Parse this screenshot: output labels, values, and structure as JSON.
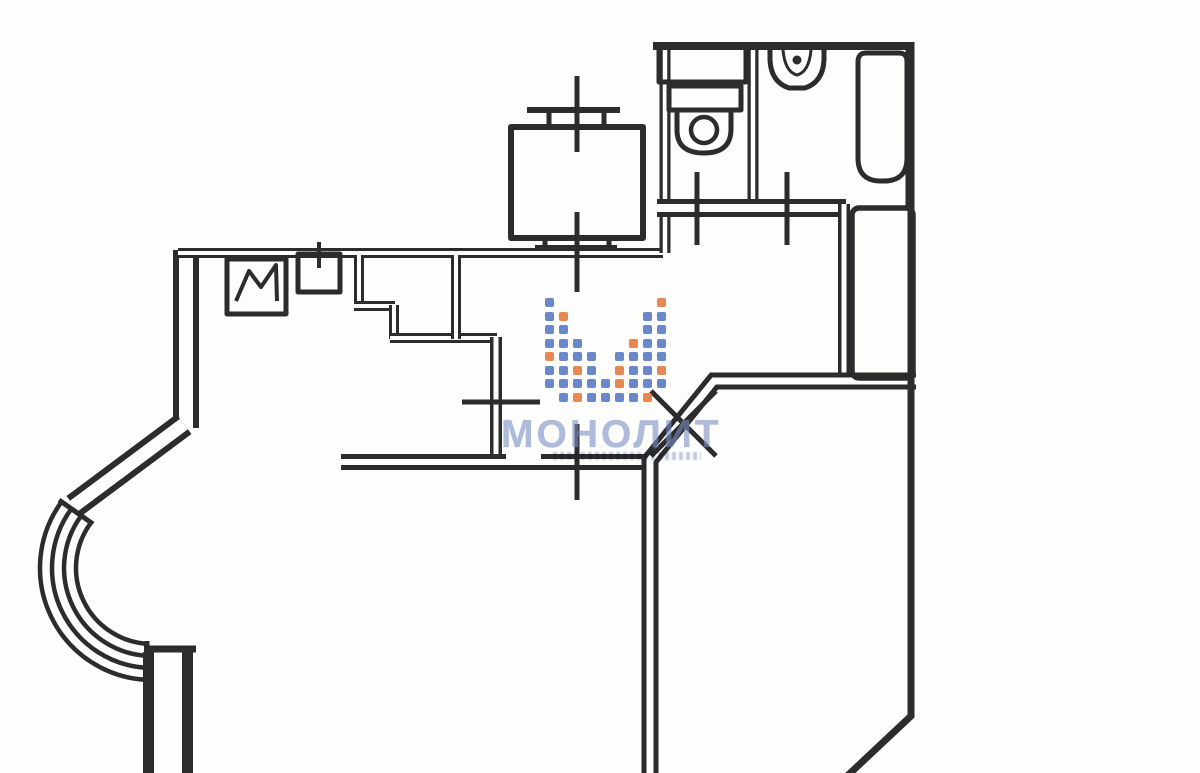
{
  "watermark": {
    "brand_text": "МОНОЛИТ",
    "text_color": "rgba(122,143,196,0.60)",
    "dot_blue": "#5577c2",
    "dot_orange": "#e4763a",
    "dot_grid": {
      "x": 545,
      "y": 298,
      "step_x": 14,
      "step_y": 13.5,
      "dot_size": 9
    },
    "dot_pattern": [
      "b.......o",
      "bo.....bb",
      "bb.....bb",
      "bbb...obb",
      "obbb.bbbb",
      "bbob.obbo",
      "bbbbbobbb",
      ".bobbbbo."
    ],
    "text_pos": {
      "x": 501,
      "y": 413
    },
    "tagline_pos": {
      "x": 553,
      "y": 452
    }
  },
  "floorplan": {
    "ink": "#2c2c2c",
    "paper": "#fdfdfc",
    "walls": [
      {
        "name": "left-outer-wall-upper",
        "d": "M 186 250 L 186 428",
        "band": 26,
        "gap": 14
      },
      {
        "name": "bay-pier-wall",
        "d": "M 184 424 L 74 506",
        "band": 25,
        "gap": 13
      },
      {
        "name": "left-outer-wall-lower",
        "d": "M 168 652 L 168 780",
        "band": 50,
        "gap": 28
      },
      {
        "name": "kitchen-north-wall",
        "d": "M 178 253 L 663 253",
        "band": 10,
        "gap": 4
      },
      {
        "name": "wc-west-wall",
        "d": "M 665 44 L 665 253",
        "band": 11,
        "gap": 4.5
      },
      {
        "name": "wc-bath-divider-wall",
        "d": "M 753 44 L 753 203",
        "band": 11,
        "gap": 4.5
      },
      {
        "name": "sanitary-south-wall",
        "d": "M 657 208 L 846 208",
        "band": 18,
        "gap": 8
      },
      {
        "name": "corridor-east-wall",
        "d": "M 844 204 L 844 380",
        "band": 12,
        "gap": 5
      },
      {
        "name": "closet-west-wall",
        "d": "M 359 255 L 359 307",
        "band": 10,
        "gap": 4
      },
      {
        "name": "closet-step-wall-a",
        "d": "M 354 306 L 395 306",
        "band": 10,
        "gap": 4
      },
      {
        "name": "closet-step-wall-b",
        "d": "M 394 305 L 394 339",
        "band": 10,
        "gap": 4
      },
      {
        "name": "closet-step-wall-c",
        "d": "M 390 338 L 497 338",
        "band": 10,
        "gap": 4
      },
      {
        "name": "closet-east-wall",
        "d": "M 456 255 L 456 339",
        "band": 10,
        "gap": 4
      },
      {
        "name": "hall-west-wall",
        "d": "M 496 337 L 496 459",
        "band": 12,
        "gap": 5
      },
      {
        "name": "hall-south-wall",
        "d": "M 341 462 L 650 462",
        "band": 16,
        "gap": 6
      },
      {
        "name": "hall-east-wall-with-diagonal",
        "d": "M 916 381 L 714 381 L 650 460 L 650 780",
        "band": 17,
        "gap": 7
      }
    ],
    "erase": [
      {
        "name": "hall-south-wall-opening",
        "d": "M 506 456 L 541 456",
        "w": 9
      }
    ],
    "marks": [
      {
        "name": "sanitary-north-wall",
        "d": "M 653 46 L 914 46",
        "w": 8
      },
      {
        "name": "right-outer-wall-upper",
        "d": "M 910 42 L 910 206",
        "w": 9
      },
      {
        "name": "right-outer-wall-lower",
        "d": "M 911 204 L 911 716 L 845 778",
        "w": 7
      },
      {
        "name": "bay-bottom-cap",
        "d": "M 144 649 L 196 649",
        "w": 7
      },
      {
        "name": "bay-arc-cap-top",
        "d": "M 59 500 L 93 524",
        "w": 5
      },
      {
        "name": "bay-arc-cap-bottom",
        "d": "M 147 641 L 147 683",
        "w": 5
      },
      {
        "name": "bay-window-arc-1",
        "d": "M 61.4 502.1 A 112 112 0 0 0 148.1 679.9",
        "w": 4.5
      },
      {
        "name": "bay-window-arc-2",
        "d": "M 71.1 509.2 A 100 100 0 0 0 148.5 667.9",
        "w": 4.5
      },
      {
        "name": "bay-window-arc-3",
        "d": "M 80.8 516.3 A 88 88 0 0 0 148.9 655.9",
        "w": 4.5
      },
      {
        "name": "bay-window-arc-4",
        "d": "M 90.5 523.3 A 76 76 0 0 0 149.3 643.9",
        "w": 4.5
      },
      {
        "name": "wc-door-tick",
        "d": "M 697 172 L 697 245",
        "w": 5
      },
      {
        "name": "bath-door-tick",
        "d": "M 787 172 L 787 245",
        "w": 5
      },
      {
        "name": "kitchen-door-tick",
        "d": "M 462 402 L 540 402",
        "w": 5
      },
      {
        "name": "living-door-tick",
        "d": "M 577 424 L 577 500",
        "w": 5
      },
      {
        "name": "kitchen-sink-tick",
        "d": "M 319 242 L 319 268",
        "w": 4
      },
      {
        "name": "entrance-door-x-mark-a",
        "d": "M 651 391 L 716 456",
        "w": 5
      },
      {
        "name": "entrance-door-x-mark-b",
        "d": "M 716 391 L 651 456",
        "w": 5
      },
      {
        "name": "vent-axis-upper",
        "d": "M 577 76 L 577 152",
        "w": 5
      },
      {
        "name": "vent-axis-lower",
        "d": "M 577 212 L 577 292",
        "w": 5
      },
      {
        "name": "vent-flange-top-bar",
        "d": "M 527 110 L 620 110",
        "w": 6
      },
      {
        "name": "vent-flange-top-leg-a",
        "d": "M 549 110 L 549 128",
        "w": 5
      },
      {
        "name": "vent-flange-top-leg-b",
        "d": "M 604 110 L 604 128",
        "w": 5
      },
      {
        "name": "vent-flange-bottom-leg-a",
        "d": "M 545 238 L 545 248",
        "w": 5
      },
      {
        "name": "vent-flange-bottom-leg-b",
        "d": "M 609 238 L 609 248",
        "w": 5
      },
      {
        "name": "vent-flange-bottom-bar",
        "d": "M 535 248 L 617 248",
        "w": 6
      }
    ],
    "fixtures": [
      {
        "name": "vent-shaft-box",
        "d": "M 511 127 L 643 127 L 643 238 L 511 238 Z",
        "w": 6
      },
      {
        "name": "wc-shelf",
        "d": "M 659 46 L 746 46 L 746 82 L 659 82 Z",
        "w": 5
      },
      {
        "name": "toilet-tank",
        "d": "M 669 86 L 741 86 L 741 110 L 669 110 Z",
        "w": 5
      },
      {
        "name": "toilet-bowl",
        "d": "M 677 108 L 677 130 Q 677 153 704 153 Q 731 153 731 129 L 731 108",
        "w": 5
      },
      {
        "name": "toilet-bowl-circle",
        "circle": [
          704,
          130,
          13
        ],
        "w": 4.5
      },
      {
        "name": "bath-sink-basin",
        "d": "M 770 50 L 770 60 Q 771 82 789 88 L 805 88 Q 823 82 824 60 L 824 50",
        "w": 5
      },
      {
        "name": "bath-sink-inner",
        "d": "M 783 50 Q 785 72 797 75 Q 809 72 811 50",
        "w": 3
      },
      {
        "name": "bath-sink-dot",
        "circle": [
          797,
          60,
          4.5
        ],
        "w": 0,
        "fill": true
      },
      {
        "name": "bathtub",
        "d": "M 858 62 Q 858 53 866 53 L 899 53 Q 907 53 907 62 L 907 158 Q 907 181 884 181 L 881 181 Q 858 181 858 158 Z",
        "w": 5
      },
      {
        "name": "stove-box",
        "d": "M 227 259 L 286 259 L 286 314 L 227 314 Z",
        "w": 5
      },
      {
        "name": "stove-zigzag",
        "d": "M 236 301 L 249 271 L 261 287 L 276 265 L 277 301",
        "w": 4
      },
      {
        "name": "kitchen-sink-box",
        "d": "M 298 254 L 340 254 L 340 292 L 298 292 Z",
        "w": 5
      },
      {
        "name": "duct-box",
        "rect": [
          852,
          208,
          61,
          170,
          7
        ],
        "w": 5.5
      }
    ]
  }
}
